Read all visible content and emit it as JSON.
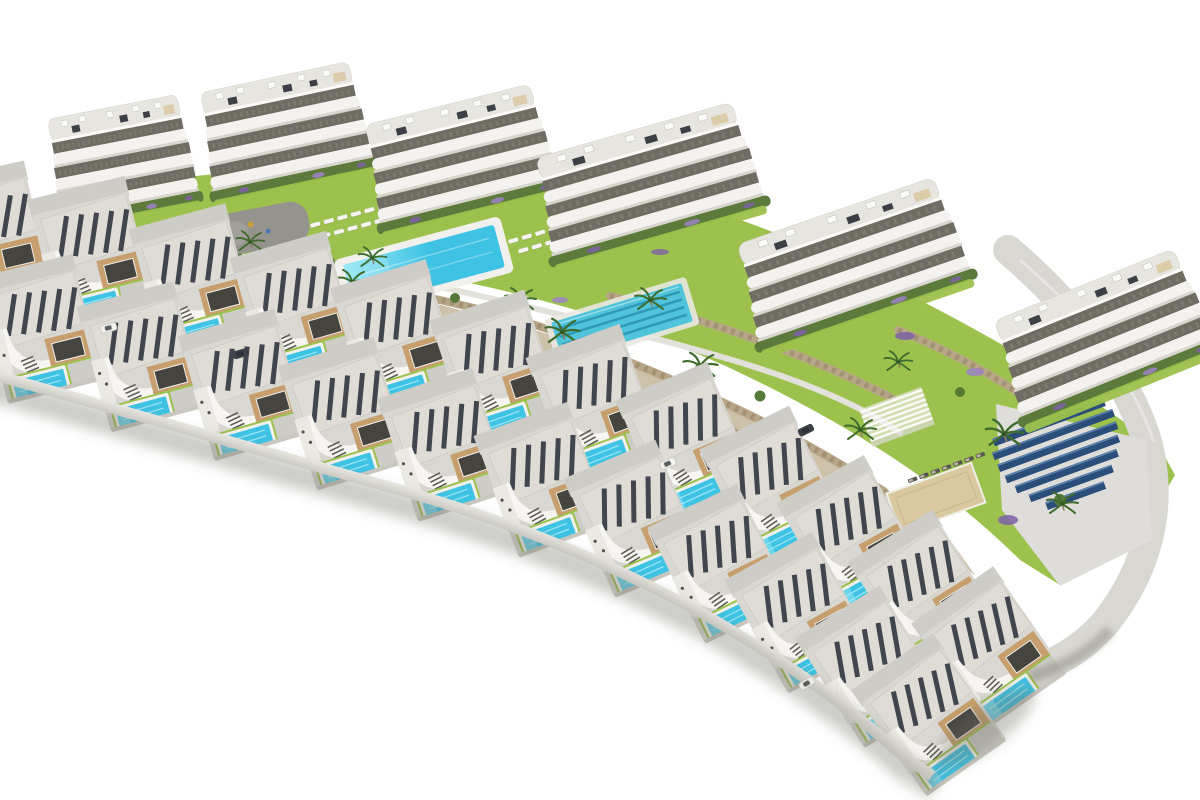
{
  "scene": {
    "type": "architectural-render",
    "description": "Aerial 3D render of a hillside residential development on a white background: six white apartment blocks with curved balconies along the top, two diagonal rows of modern villas each with a private turquoise pool, a communal swimming pool, a lap pool, lawns, stone terrace walls, palm trees, purple flower beds, a playground plaza, a pergola, a sand court, a solar panel field and a curving access road.",
    "view": "high-angle isometric aerial view",
    "background": "white"
  },
  "counts": {
    "apartment_blocks": 6,
    "villas": 24,
    "private_pools": 22,
    "communal_pools": 2,
    "lap_pool_lanes": 4,
    "solar_panel_rows": 7,
    "palm_trees": 14,
    "cars": 5
  },
  "colors": {
    "bg": "#ffffff",
    "bldWhite": "#f3f2ee",
    "bldShade": "#d7d5ce",
    "bldDark": "#6e6c63",
    "bldRoof": "#e7e5df",
    "hedge": "#5c7a3c",
    "lawn": "#9cc14c",
    "lawnLight": "#abce5f",
    "wallStone": "#b7a687",
    "wallStoneDark": "#94825f",
    "slope": "#c8baa0",
    "pool": "#3fc3e4",
    "poolLight": "#9be7f5",
    "poolDeck": "#f1f0ec",
    "lanePool": "#4fc4da",
    "laneLine": "#2e9ab8",
    "road": "#d8d7d2",
    "street": "#cdccc6",
    "plaza": "#95938e",
    "solar": "#2b4d7a",
    "solarLight": "#5b82ad",
    "sand": "#d9c8a0",
    "villaRoof": "#dedcd4",
    "panel": "#41464e",
    "canopy": "#f6f5f1",
    "villaWall": "#c79f6e",
    "windowDark": "#45443e",
    "purple": "#7e60a8",
    "purpleLight": "#9d82c6",
    "palm": "#3f6b2d",
    "treeGreen": "#567a3a",
    "carDark": "#3c3f45",
    "carWhite": "#f2f2ef",
    "shadow": "rgba(110,108,100,0.35)"
  }
}
